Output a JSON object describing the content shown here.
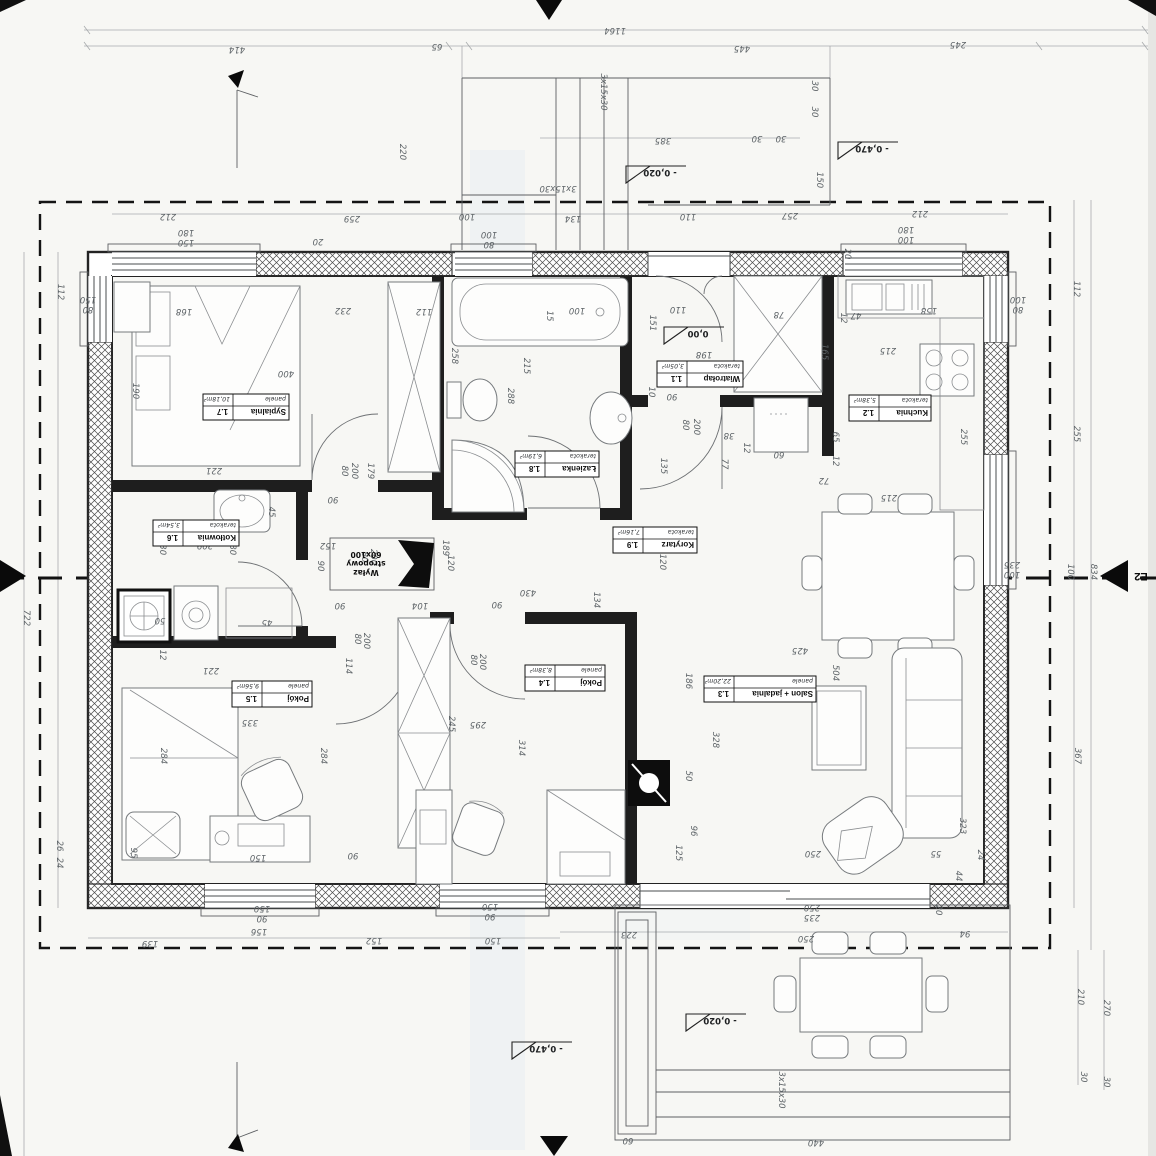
{
  "sheet": {
    "kind": "floor-plan-scan",
    "orientation_note": "plan annotations rotated 180°"
  },
  "colors": {
    "paper": "#f7f7f4",
    "ink": "#1e1e1e",
    "dim_text": "#5d6367",
    "tint": "#d9e5ef"
  },
  "rooms": [
    {
      "name": "Sypialnia",
      "num": "1.7",
      "floor": "panele",
      "area": "10,18m²",
      "cx": 246,
      "cy": 407,
      "w": 86
    },
    {
      "name": "Łazienka",
      "num": "1.8",
      "floor": "terakota",
      "area": "6,19m²",
      "cx": 557,
      "cy": 464,
      "w": 84
    },
    {
      "name": "Wiatrołap",
      "num": "1.1",
      "floor": "terakota",
      "area": "3,05m²",
      "cx": 700,
      "cy": 374,
      "w": 86
    },
    {
      "name": "Kuchnia",
      "num": "1.2",
      "floor": "terakota",
      "area": "5,38m²",
      "cx": 890,
      "cy": 408,
      "w": 82
    },
    {
      "name": "Korytarz",
      "num": "1.9",
      "floor": "terakota",
      "area": "7,16m²",
      "cx": 655,
      "cy": 540,
      "w": 84
    },
    {
      "name": "Kotłownia",
      "num": "1.6",
      "floor": "terakota",
      "area": "3,54m²",
      "cx": 196,
      "cy": 533,
      "w": 86
    },
    {
      "name": "Pokój",
      "num": "1.5",
      "floor": "panele",
      "area": "9,56m²",
      "cx": 272,
      "cy": 694,
      "w": 80
    },
    {
      "name": "Pokój",
      "num": "1.4",
      "floor": "panele",
      "area": "8,38m²",
      "cx": 565,
      "cy": 678,
      "w": 80
    },
    {
      "name": "Salon + jadalnia",
      "num": "1.3",
      "floor": "panele",
      "area": "22,20m²",
      "cx": 760,
      "cy": 689,
      "w": 112
    }
  ],
  "levels": [
    {
      "t": "0,00",
      "x": 690,
      "y": 327
    },
    {
      "t": "- 0,020",
      "x": 652,
      "y": 166
    },
    {
      "t": "- 0,470",
      "x": 864,
      "y": 142
    },
    {
      "t": "- 0,020",
      "x": 712,
      "y": 1014
    },
    {
      "t": "- 0,470",
      "x": 538,
      "y": 1042
    }
  ],
  "hatch_annotation": {
    "lines": [
      "Wyłaz",
      "stropowy",
      "60x100"
    ],
    "x": 366,
    "y": 552
  },
  "section_markers": [
    {
      "label": "E2",
      "x": 1141,
      "y": 581
    }
  ],
  "dimensions": [
    {
      "t": "1164",
      "x": 615,
      "y": 28,
      "r": 180
    },
    {
      "t": "414",
      "x": 237,
      "y": 47,
      "r": 180
    },
    {
      "t": "65",
      "x": 437,
      "y": 44,
      "r": 180
    },
    {
      "t": "445",
      "x": 742,
      "y": 46,
      "r": 180
    },
    {
      "t": "245",
      "x": 958,
      "y": 42,
      "r": 180
    },
    {
      "t": "220",
      "x": 400,
      "y": 152,
      "r": 90
    },
    {
      "t": "3x15x30",
      "x": 601,
      "y": 92,
      "r": 90
    },
    {
      "t": "385",
      "x": 663,
      "y": 138,
      "r": 180
    },
    {
      "t": "30",
      "x": 757,
      "y": 136,
      "r": 180
    },
    {
      "t": "30",
      "x": 781,
      "y": 136,
      "r": 180
    },
    {
      "t": "30",
      "x": 812,
      "y": 86,
      "r": 90
    },
    {
      "t": "30",
      "x": 812,
      "y": 112,
      "r": 90
    },
    {
      "t": "150",
      "x": 817,
      "y": 180,
      "r": 90
    },
    {
      "t": "3x15x30",
      "x": 558,
      "y": 186,
      "r": 180
    },
    {
      "t": "212",
      "x": 168,
      "y": 214,
      "r": 180
    },
    {
      "t": "259",
      "x": 352,
      "y": 216,
      "r": 180
    },
    {
      "t": "100",
      "x": 467,
      "y": 214,
      "r": 180
    },
    {
      "t": "134",
      "x": 573,
      "y": 216,
      "r": 180
    },
    {
      "t": "110",
      "x": 688,
      "y": 214,
      "r": 180
    },
    {
      "t": "257",
      "x": 790,
      "y": 213,
      "r": 180
    },
    {
      "t": "212",
      "x": 920,
      "y": 211,
      "r": 180
    },
    {
      "t": "180",
      "x": 186,
      "y": 230,
      "r": 180
    },
    {
      "t": "150",
      "x": 186,
      "y": 240,
      "r": 180
    },
    {
      "t": "20",
      "x": 318,
      "y": 239,
      "r": 180
    },
    {
      "t": "100",
      "x": 489,
      "y": 232,
      "r": 180
    },
    {
      "t": "80",
      "x": 489,
      "y": 242,
      "r": 180
    },
    {
      "t": "180",
      "x": 906,
      "y": 227,
      "r": 180
    },
    {
      "t": "100",
      "x": 906,
      "y": 237,
      "r": 180
    },
    {
      "t": "20",
      "x": 845,
      "y": 254,
      "r": 90
    },
    {
      "t": "112",
      "x": 58,
      "y": 292,
      "r": 90
    },
    {
      "t": "722",
      "x": 24,
      "y": 618,
      "r": 90
    },
    {
      "t": "150",
      "x": 88,
      "y": 297,
      "r": 180
    },
    {
      "t": "80",
      "x": 88,
      "y": 307,
      "r": 180
    },
    {
      "t": "26",
      "x": 57,
      "y": 846,
      "r": 90
    },
    {
      "t": "24",
      "x": 57,
      "y": 863,
      "r": 90
    },
    {
      "t": "112",
      "x": 1074,
      "y": 289,
      "r": 90
    },
    {
      "t": "255",
      "x": 1074,
      "y": 434,
      "r": 90
    },
    {
      "t": "100",
      "x": 1068,
      "y": 572,
      "r": 90
    },
    {
      "t": "834",
      "x": 1091,
      "y": 572,
      "r": 90
    },
    {
      "t": "100",
      "x": 1018,
      "y": 297,
      "r": 180
    },
    {
      "t": "80",
      "x": 1018,
      "y": 307,
      "r": 180
    },
    {
      "t": "235",
      "x": 1012,
      "y": 562,
      "r": 180
    },
    {
      "t": "100",
      "x": 1012,
      "y": 572,
      "r": 180
    },
    {
      "t": "367",
      "x": 1075,
      "y": 756,
      "r": 90
    },
    {
      "t": "210",
      "x": 1078,
      "y": 997,
      "r": 90
    },
    {
      "t": "270",
      "x": 1104,
      "y": 1008,
      "r": 90
    },
    {
      "t": "30",
      "x": 1081,
      "y": 1077,
      "r": 90
    },
    {
      "t": "30",
      "x": 1104,
      "y": 1082,
      "r": 90
    },
    {
      "t": "139",
      "x": 150,
      "y": 941,
      "r": 180
    },
    {
      "t": "156",
      "x": 259,
      "y": 929,
      "r": 180
    },
    {
      "t": "152",
      "x": 374,
      "y": 938,
      "r": 180
    },
    {
      "t": "150",
      "x": 493,
      "y": 938,
      "r": 180
    },
    {
      "t": "150",
      "x": 262,
      "y": 906,
      "r": 180
    },
    {
      "t": "90",
      "x": 262,
      "y": 916,
      "r": 180
    },
    {
      "t": "150",
      "x": 490,
      "y": 904,
      "r": 180
    },
    {
      "t": "90",
      "x": 490,
      "y": 914,
      "r": 180
    },
    {
      "t": "223",
      "x": 629,
      "y": 932,
      "r": 180
    },
    {
      "t": "250",
      "x": 806,
      "y": 936,
      "r": 180
    },
    {
      "t": "94",
      "x": 965,
      "y": 931,
      "r": 180
    },
    {
      "t": "20",
      "x": 936,
      "y": 910,
      "r": 90
    },
    {
      "t": "250",
      "x": 812,
      "y": 905,
      "r": 180
    },
    {
      "t": "235",
      "x": 812,
      "y": 915,
      "r": 180
    },
    {
      "t": "440",
      "x": 816,
      "y": 1140,
      "r": 180
    },
    {
      "t": "60",
      "x": 628,
      "y": 1138,
      "r": 180
    },
    {
      "t": "3x15x30",
      "x": 779,
      "y": 1090,
      "r": 90
    },
    {
      "t": "24",
      "x": 978,
      "y": 855,
      "r": 90
    },
    {
      "t": "44",
      "x": 956,
      "y": 876,
      "r": 90
    },
    {
      "t": "55",
      "x": 936,
      "y": 851,
      "r": 180
    },
    {
      "t": "323",
      "x": 960,
      "y": 826,
      "r": 90
    },
    {
      "t": "168",
      "x": 184,
      "y": 309,
      "r": 180
    },
    {
      "t": "232",
      "x": 343,
      "y": 308,
      "r": 180
    },
    {
      "t": "112",
      "x": 424,
      "y": 309,
      "r": 180
    },
    {
      "t": "400",
      "x": 286,
      "y": 371,
      "r": 180
    },
    {
      "t": "258",
      "x": 452,
      "y": 356,
      "r": 90
    },
    {
      "t": "190",
      "x": 133,
      "y": 391,
      "r": 90
    },
    {
      "t": "221",
      "x": 214,
      "y": 468,
      "r": 180
    },
    {
      "t": "288",
      "x": 508,
      "y": 396,
      "r": 90
    },
    {
      "t": "215",
      "x": 524,
      "y": 366,
      "r": 90
    },
    {
      "t": "100",
      "x": 577,
      "y": 308,
      "r": 180
    },
    {
      "t": "15",
      "x": 547,
      "y": 316,
      "r": 90
    },
    {
      "t": "110",
      "x": 678,
      "y": 307,
      "r": 180
    },
    {
      "t": "78",
      "x": 779,
      "y": 312,
      "r": 180
    },
    {
      "t": "47",
      "x": 856,
      "y": 313,
      "r": 180
    },
    {
      "t": "12",
      "x": 841,
      "y": 318,
      "r": 90
    },
    {
      "t": "151",
      "x": 650,
      "y": 323,
      "r": 90
    },
    {
      "t": "198",
      "x": 704,
      "y": 352,
      "r": 180
    },
    {
      "t": "90",
      "x": 672,
      "y": 394,
      "r": 180
    },
    {
      "t": "10",
      "x": 649,
      "y": 392,
      "r": 90
    },
    {
      "t": "80",
      "x": 683,
      "y": 425,
      "r": 90
    },
    {
      "t": "200",
      "x": 694,
      "y": 427,
      "r": 90
    },
    {
      "t": "38",
      "x": 729,
      "y": 433,
      "r": 180
    },
    {
      "t": "60",
      "x": 779,
      "y": 452,
      "r": 180
    },
    {
      "t": "12",
      "x": 744,
      "y": 448,
      "r": 90
    },
    {
      "t": "77",
      "x": 722,
      "y": 464,
      "r": 90
    },
    {
      "t": "135",
      "x": 661,
      "y": 466,
      "r": 90
    },
    {
      "t": "72",
      "x": 824,
      "y": 478,
      "r": 180
    },
    {
      "t": "65",
      "x": 833,
      "y": 437,
      "r": 90
    },
    {
      "t": "12",
      "x": 833,
      "y": 461,
      "r": 90
    },
    {
      "t": "255",
      "x": 961,
      "y": 437,
      "r": 90
    },
    {
      "t": "215",
      "x": 888,
      "y": 348,
      "r": 180
    },
    {
      "t": "158",
      "x": 929,
      "y": 308,
      "r": 180
    },
    {
      "t": "165",
      "x": 822,
      "y": 352,
      "r": 90
    },
    {
      "t": "215",
      "x": 889,
      "y": 495,
      "r": 180
    },
    {
      "t": "179",
      "x": 368,
      "y": 471,
      "r": 90
    },
    {
      "t": "80",
      "x": 342,
      "y": 471,
      "r": 90
    },
    {
      "t": "200",
      "x": 352,
      "y": 471,
      "r": 90
    },
    {
      "t": "90",
      "x": 333,
      "y": 497,
      "r": 180
    },
    {
      "t": "45",
      "x": 269,
      "y": 512,
      "r": 90
    },
    {
      "t": "209",
      "x": 205,
      "y": 543,
      "r": 180
    },
    {
      "t": "130",
      "x": 160,
      "y": 547,
      "r": 90
    },
    {
      "t": "180",
      "x": 230,
      "y": 547,
      "r": 90
    },
    {
      "t": "152",
      "x": 328,
      "y": 543,
      "r": 180
    },
    {
      "t": "200",
      "x": 371,
      "y": 557,
      "r": 90
    },
    {
      "t": "80",
      "x": 362,
      "y": 557,
      "r": 90
    },
    {
      "t": "90",
      "x": 318,
      "y": 566,
      "r": 90
    },
    {
      "t": "189",
      "x": 443,
      "y": 548,
      "r": 90
    },
    {
      "t": "120",
      "x": 448,
      "y": 563,
      "r": 90
    },
    {
      "t": "430",
      "x": 528,
      "y": 590,
      "r": 180
    },
    {
      "t": "90",
      "x": 497,
      "y": 602,
      "r": 180
    },
    {
      "t": "134",
      "x": 594,
      "y": 600,
      "r": 90
    },
    {
      "t": "120",
      "x": 660,
      "y": 562,
      "r": 90
    },
    {
      "t": "104",
      "x": 420,
      "y": 603,
      "r": 180
    },
    {
      "t": "90",
      "x": 340,
      "y": 603,
      "r": 180
    },
    {
      "t": "114",
      "x": 346,
      "y": 666,
      "r": 90
    },
    {
      "t": "80",
      "x": 355,
      "y": 639,
      "r": 90
    },
    {
      "t": "200",
      "x": 364,
      "y": 641,
      "r": 90
    },
    {
      "t": "12",
      "x": 160,
      "y": 655,
      "r": 90
    },
    {
      "t": "221",
      "x": 211,
      "y": 668,
      "r": 180
    },
    {
      "t": "335",
      "x": 250,
      "y": 720,
      "r": 180
    },
    {
      "t": "284",
      "x": 161,
      "y": 756,
      "r": 90
    },
    {
      "t": "284",
      "x": 321,
      "y": 756,
      "r": 90
    },
    {
      "t": "95",
      "x": 131,
      "y": 853,
      "r": 90
    },
    {
      "t": "150",
      "x": 258,
      "y": 855,
      "r": 180
    },
    {
      "t": "90",
      "x": 353,
      "y": 853,
      "r": 180
    },
    {
      "t": "50",
      "x": 160,
      "y": 618,
      "r": 180
    },
    {
      "t": "45",
      "x": 267,
      "y": 620,
      "r": 180
    },
    {
      "t": "295",
      "x": 478,
      "y": 722,
      "r": 180
    },
    {
      "t": "80",
      "x": 471,
      "y": 660,
      "r": 90
    },
    {
      "t": "200",
      "x": 480,
      "y": 662,
      "r": 90
    },
    {
      "t": "245",
      "x": 449,
      "y": 724,
      "r": 90
    },
    {
      "t": "314",
      "x": 519,
      "y": 748,
      "r": 90
    },
    {
      "t": "186",
      "x": 686,
      "y": 681,
      "r": 90
    },
    {
      "t": "328",
      "x": 713,
      "y": 740,
      "r": 90
    },
    {
      "t": "50",
      "x": 686,
      "y": 776,
      "r": 90
    },
    {
      "t": "96",
      "x": 691,
      "y": 831,
      "r": 90
    },
    {
      "t": "125",
      "x": 676,
      "y": 853,
      "r": 90
    },
    {
      "t": "250",
      "x": 813,
      "y": 851,
      "r": 180
    },
    {
      "t": "425",
      "x": 800,
      "y": 648,
      "r": 180
    },
    {
      "t": "504",
      "x": 833,
      "y": 673,
      "r": 90
    }
  ]
}
